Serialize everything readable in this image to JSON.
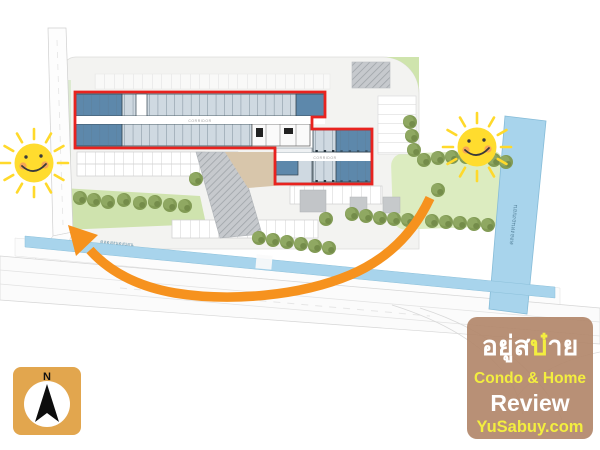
{
  "title": "Condo project site plan with highlighted building floor plan",
  "labels": {
    "corridor_main": "CORRIDOR",
    "corridor_wing": "CORRIDOR",
    "canal_horizontal": "คลองหนองบอน",
    "canal_vertical": "คลองหนองบอน",
    "compass_north": "N"
  },
  "watermark": {
    "brand_prefix": "อยู่ส",
    "brand_highlight": "บ๋",
    "brand_suffix": "าย",
    "tagline": "Condo & Home",
    "review": "Review",
    "site": "YuSabuy.com"
  },
  "colors": {
    "highlight_red": "#e8231f",
    "arrow_orange": "#f6921e",
    "sun_yellow": "#ffdc2e",
    "canal_blue": "#a8d4ec",
    "unit_dark_blue": "#5d88ab",
    "unit_light": "#cfd9e1",
    "garden_green": "#dcecc0",
    "tree_green": "#829b55",
    "watermark_tan": "#b2876a",
    "watermark_yellow": "#f3ee3f",
    "compass_tan": "#e2a64e"
  }
}
